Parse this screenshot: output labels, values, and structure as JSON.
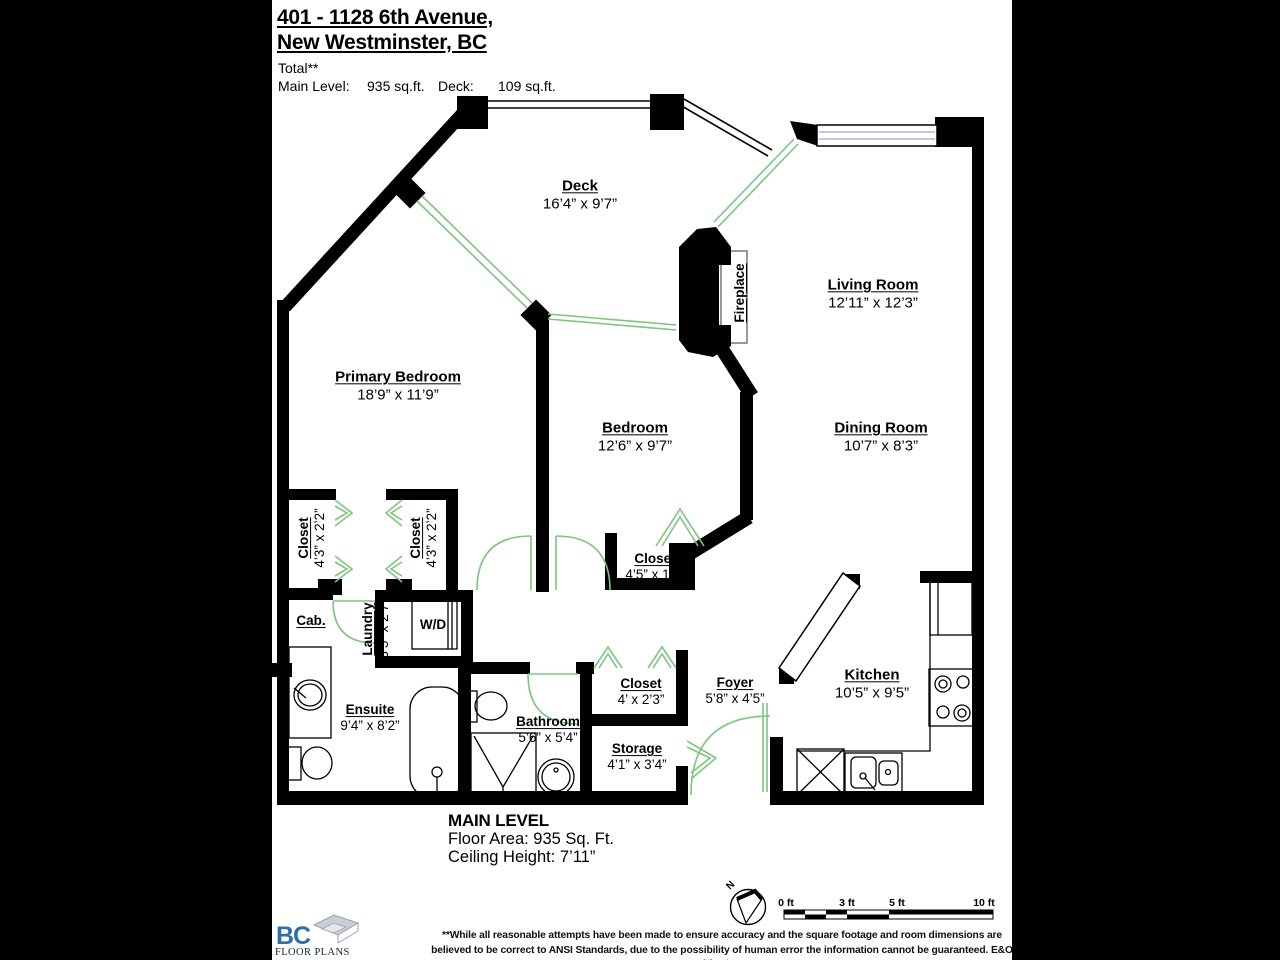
{
  "header": {
    "address_line1": "401 - 1128 6th Avenue,",
    "address_line2": "New Westminster, BC",
    "total_label": "Total**",
    "main_level_label": "Main Level:",
    "main_level_value": "935 sq.ft.",
    "deck_label": "Deck:",
    "deck_value": "109 sq.ft."
  },
  "rooms": {
    "deck": {
      "name": "Deck",
      "dims": "16’4” x 9’7”"
    },
    "living_room": {
      "name": "Living Room",
      "dims": "12’11” x 12’3”"
    },
    "dining_room": {
      "name": "Dining Room",
      "dims": "10’7” x 8’3”"
    },
    "primary_bedroom": {
      "name": "Primary Bedroom",
      "dims": "18’9” x 11’9”"
    },
    "bedroom": {
      "name": "Bedroom",
      "dims": "12’6” x 9’7”"
    },
    "bedroom_closet": {
      "name": "Closet",
      "dims": "4’5” x 1’9”"
    },
    "closet1": {
      "name": "Closet",
      "dims": "4’3” x 2’2”"
    },
    "closet2": {
      "name": "Closet",
      "dims": "4’3” x 2’2”"
    },
    "laundry": {
      "name": "Laundry",
      "dims": "3’5” x 2’7”"
    },
    "cab": {
      "name": "Cab."
    },
    "wd": {
      "name": "W/D"
    },
    "ensuite": {
      "name": "Ensuite",
      "dims": "9’4” x 8’2”"
    },
    "bathroom": {
      "name": "Bathroom",
      "dims": "5’6” x 5’4”"
    },
    "hall_closet": {
      "name": "Closet",
      "dims": "4’ x 2’3”"
    },
    "storage": {
      "name": "Storage",
      "dims": "4’1” x 3’4”"
    },
    "foyer": {
      "name": "Foyer",
      "dims": "5’8” x 4’5”"
    },
    "kitchen": {
      "name": "Kitchen",
      "dims": "10’5” x 9’5”"
    },
    "fireplace": {
      "name": "Fireplace"
    }
  },
  "footer": {
    "level_title": "MAIN LEVEL",
    "floor_area": "Floor Area: 935 Sq. Ft.",
    "ceiling_height": "Ceiling Height: 7’11”"
  },
  "scale_bar": {
    "labels": [
      "0 ft",
      "3 ft",
      "5 ft",
      "10 ft"
    ]
  },
  "compass": {
    "north_label": "N"
  },
  "logo": {
    "primary": "BC",
    "secondary": "FLOOR PLANS"
  },
  "disclaimer": "**While all reasonable attempts have been made to ensure accuracy and the square footage and room dimensions are believed to be correct to ANSI Standards, due to the possibility of human error the information cannot be guaranteed. E&O Insured for $1,000,000",
  "colors": {
    "wall": "#000000",
    "door_window_green": "#7cc67e",
    "window_glass_blue": "#adb4e0",
    "logo_blue": "#2e6da8",
    "background": "#ffffff"
  }
}
